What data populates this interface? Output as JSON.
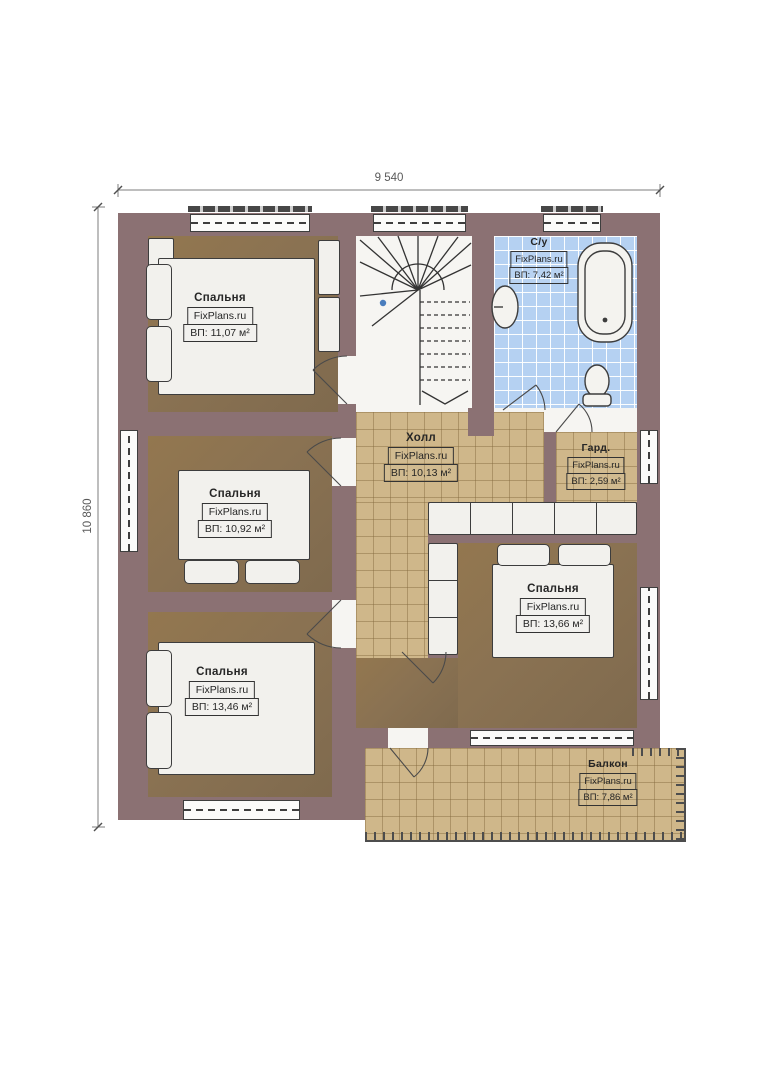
{
  "dimensions": {
    "top": "9 540",
    "left": "10 860"
  },
  "brand": "FixPlans.ru",
  "rooms": [
    {
      "id": "bedroom-top-left",
      "name": "Спальня",
      "brand": "FixPlans.ru",
      "area": "ВП: 11,07 м²"
    },
    {
      "id": "bathroom",
      "name": "С/у",
      "brand": "FixPlans.ru",
      "area": "ВП: 7,42 м²"
    },
    {
      "id": "hall",
      "name": "Холл",
      "brand": "FixPlans.ru",
      "area": "ВП: 10,13 м²"
    },
    {
      "id": "wardrobe",
      "name": "Гард.",
      "brand": "FixPlans.ru",
      "area": "ВП: 2,59 м²"
    },
    {
      "id": "bedroom-middle-left",
      "name": "Спальня",
      "brand": "FixPlans.ru",
      "area": "ВП: 10,92 м²"
    },
    {
      "id": "bedroom-bottom-left",
      "name": "Спальня",
      "brand": "FixPlans.ru",
      "area": "ВП: 13,46 м²"
    },
    {
      "id": "bedroom-right",
      "name": "Спальня",
      "brand": "FixPlans.ru",
      "area": "ВП: 13,66 м²"
    },
    {
      "id": "balcony",
      "name": "Балкон",
      "brand": "FixPlans.ru",
      "area": "ВП: 7,86 м²"
    }
  ],
  "colors": {
    "wall": "#8b7173",
    "wood_floor": "#8a7252",
    "tile_tan": "#cfb78a",
    "tile_blue": "#b5d1f2",
    "furniture": "#f2f1ed",
    "stair_dot": "#4a7dbd"
  }
}
